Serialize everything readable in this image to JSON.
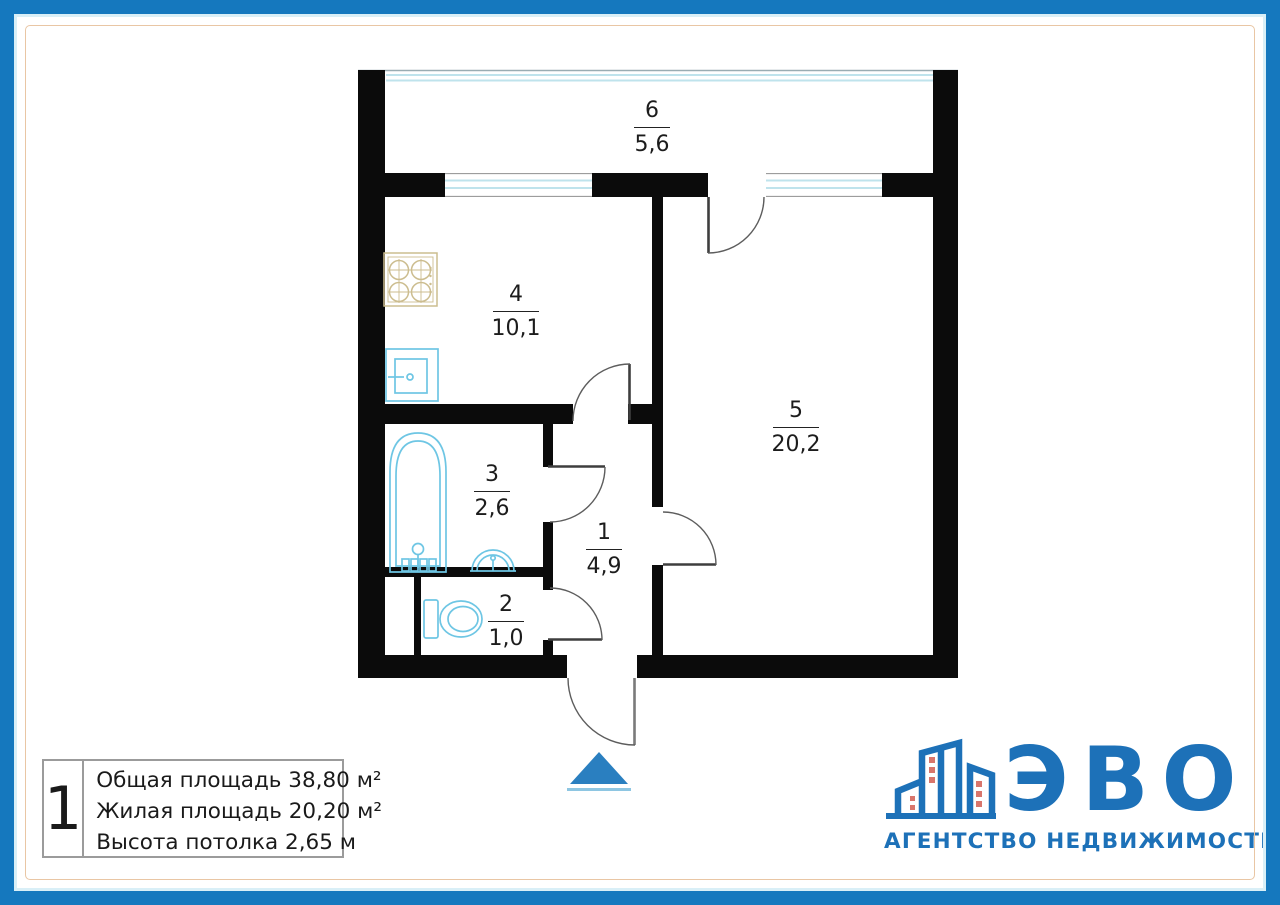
{
  "plan": {
    "rooms": {
      "r1": {
        "number": "1",
        "area": "4,9"
      },
      "r2": {
        "number": "2",
        "area": "1,0"
      },
      "r3": {
        "number": "3",
        "area": "2,6"
      },
      "r4": {
        "number": "4",
        "area": "10,1"
      },
      "r5": {
        "number": "5",
        "area": "20,2"
      },
      "r6": {
        "number": "6",
        "area": "5,6"
      }
    }
  },
  "legend": {
    "plan_number": "1",
    "total_area": "Общая площадь 38,80 м²",
    "living_area": "Жилая площадь 20,20 м²",
    "ceiling_height": "Высота потолка 2,65 м"
  },
  "logo": {
    "name": "ЭВО",
    "tagline": "АГЕНТСТВО НЕДВИЖИМОСТИ"
  },
  "colors": {
    "frame_blue": "#1578be",
    "frame_cyan": "#d9eff7",
    "frame_tan": "#e9c6a4",
    "wall": "#0b0b0b",
    "text": "#1c1c1c",
    "fixture": "#6ec6e4",
    "window_glass": "#bfe3ec",
    "stove": "#ccbd8f",
    "arrow": "#2a7fc0",
    "arrow_underline": "#8ec6e2",
    "logo_blue": "#1d71b8",
    "logo_window": "#d9766c"
  }
}
